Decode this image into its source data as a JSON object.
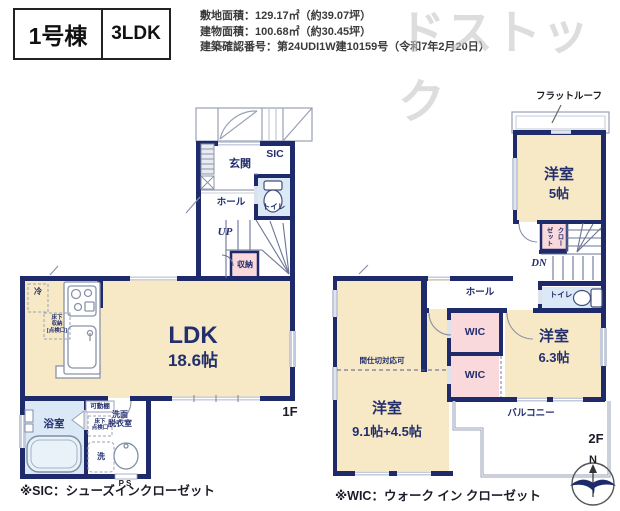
{
  "header": {
    "unit": "1号棟",
    "layout": "3LDK",
    "land_area": "敷地面積：129.17㎡（約39.07坪）",
    "building_area": "建物面積：100.68㎡（約30.45坪）",
    "permit": "建築確認番号：第24UDI1W建10159号（令和7年2月20日）"
  },
  "watermark": {
    "text": "ドストック"
  },
  "floor1": {
    "floor_label": "1F",
    "rooms": {
      "genkan": "玄関",
      "sic": "SIC",
      "toilet": "トイレ",
      "hall": "ホール",
      "up": "UP",
      "storage": "収納",
      "ldk": "LDK",
      "ldk_size": "18.6帖",
      "fridge": "冷",
      "underfloor_storage": "床下\n収納\n[点検口]",
      "shelf": "可動棚",
      "underfloor_access": "床下\n点検口",
      "washer": "洗",
      "bath": "浴室",
      "wash_room": "洗面\n脱衣室",
      "ps": "PS"
    }
  },
  "floor2": {
    "floor_label": "2F",
    "rooms": {
      "flat_roof": "フラットルーフ",
      "room5": "洋室",
      "room5_size": "5帖",
      "closet": "クローゼット",
      "dn": "DN",
      "hall": "ホール",
      "toilet": "トイレ",
      "wic_upper": "WIC",
      "wic_lower": "WIC",
      "room63": "洋室",
      "room63_size": "6.3帖",
      "partition_note": "間仕切対応可",
      "room91": "洋室",
      "room91_size": "9.1帖+4.5帖",
      "balcony": "バルコニー"
    }
  },
  "notes": {
    "sic": "※SIC：シューズインクローゼット",
    "wic": "※WIC：ウォーク イン クローゼット"
  },
  "compass": {
    "north": "N"
  }
}
